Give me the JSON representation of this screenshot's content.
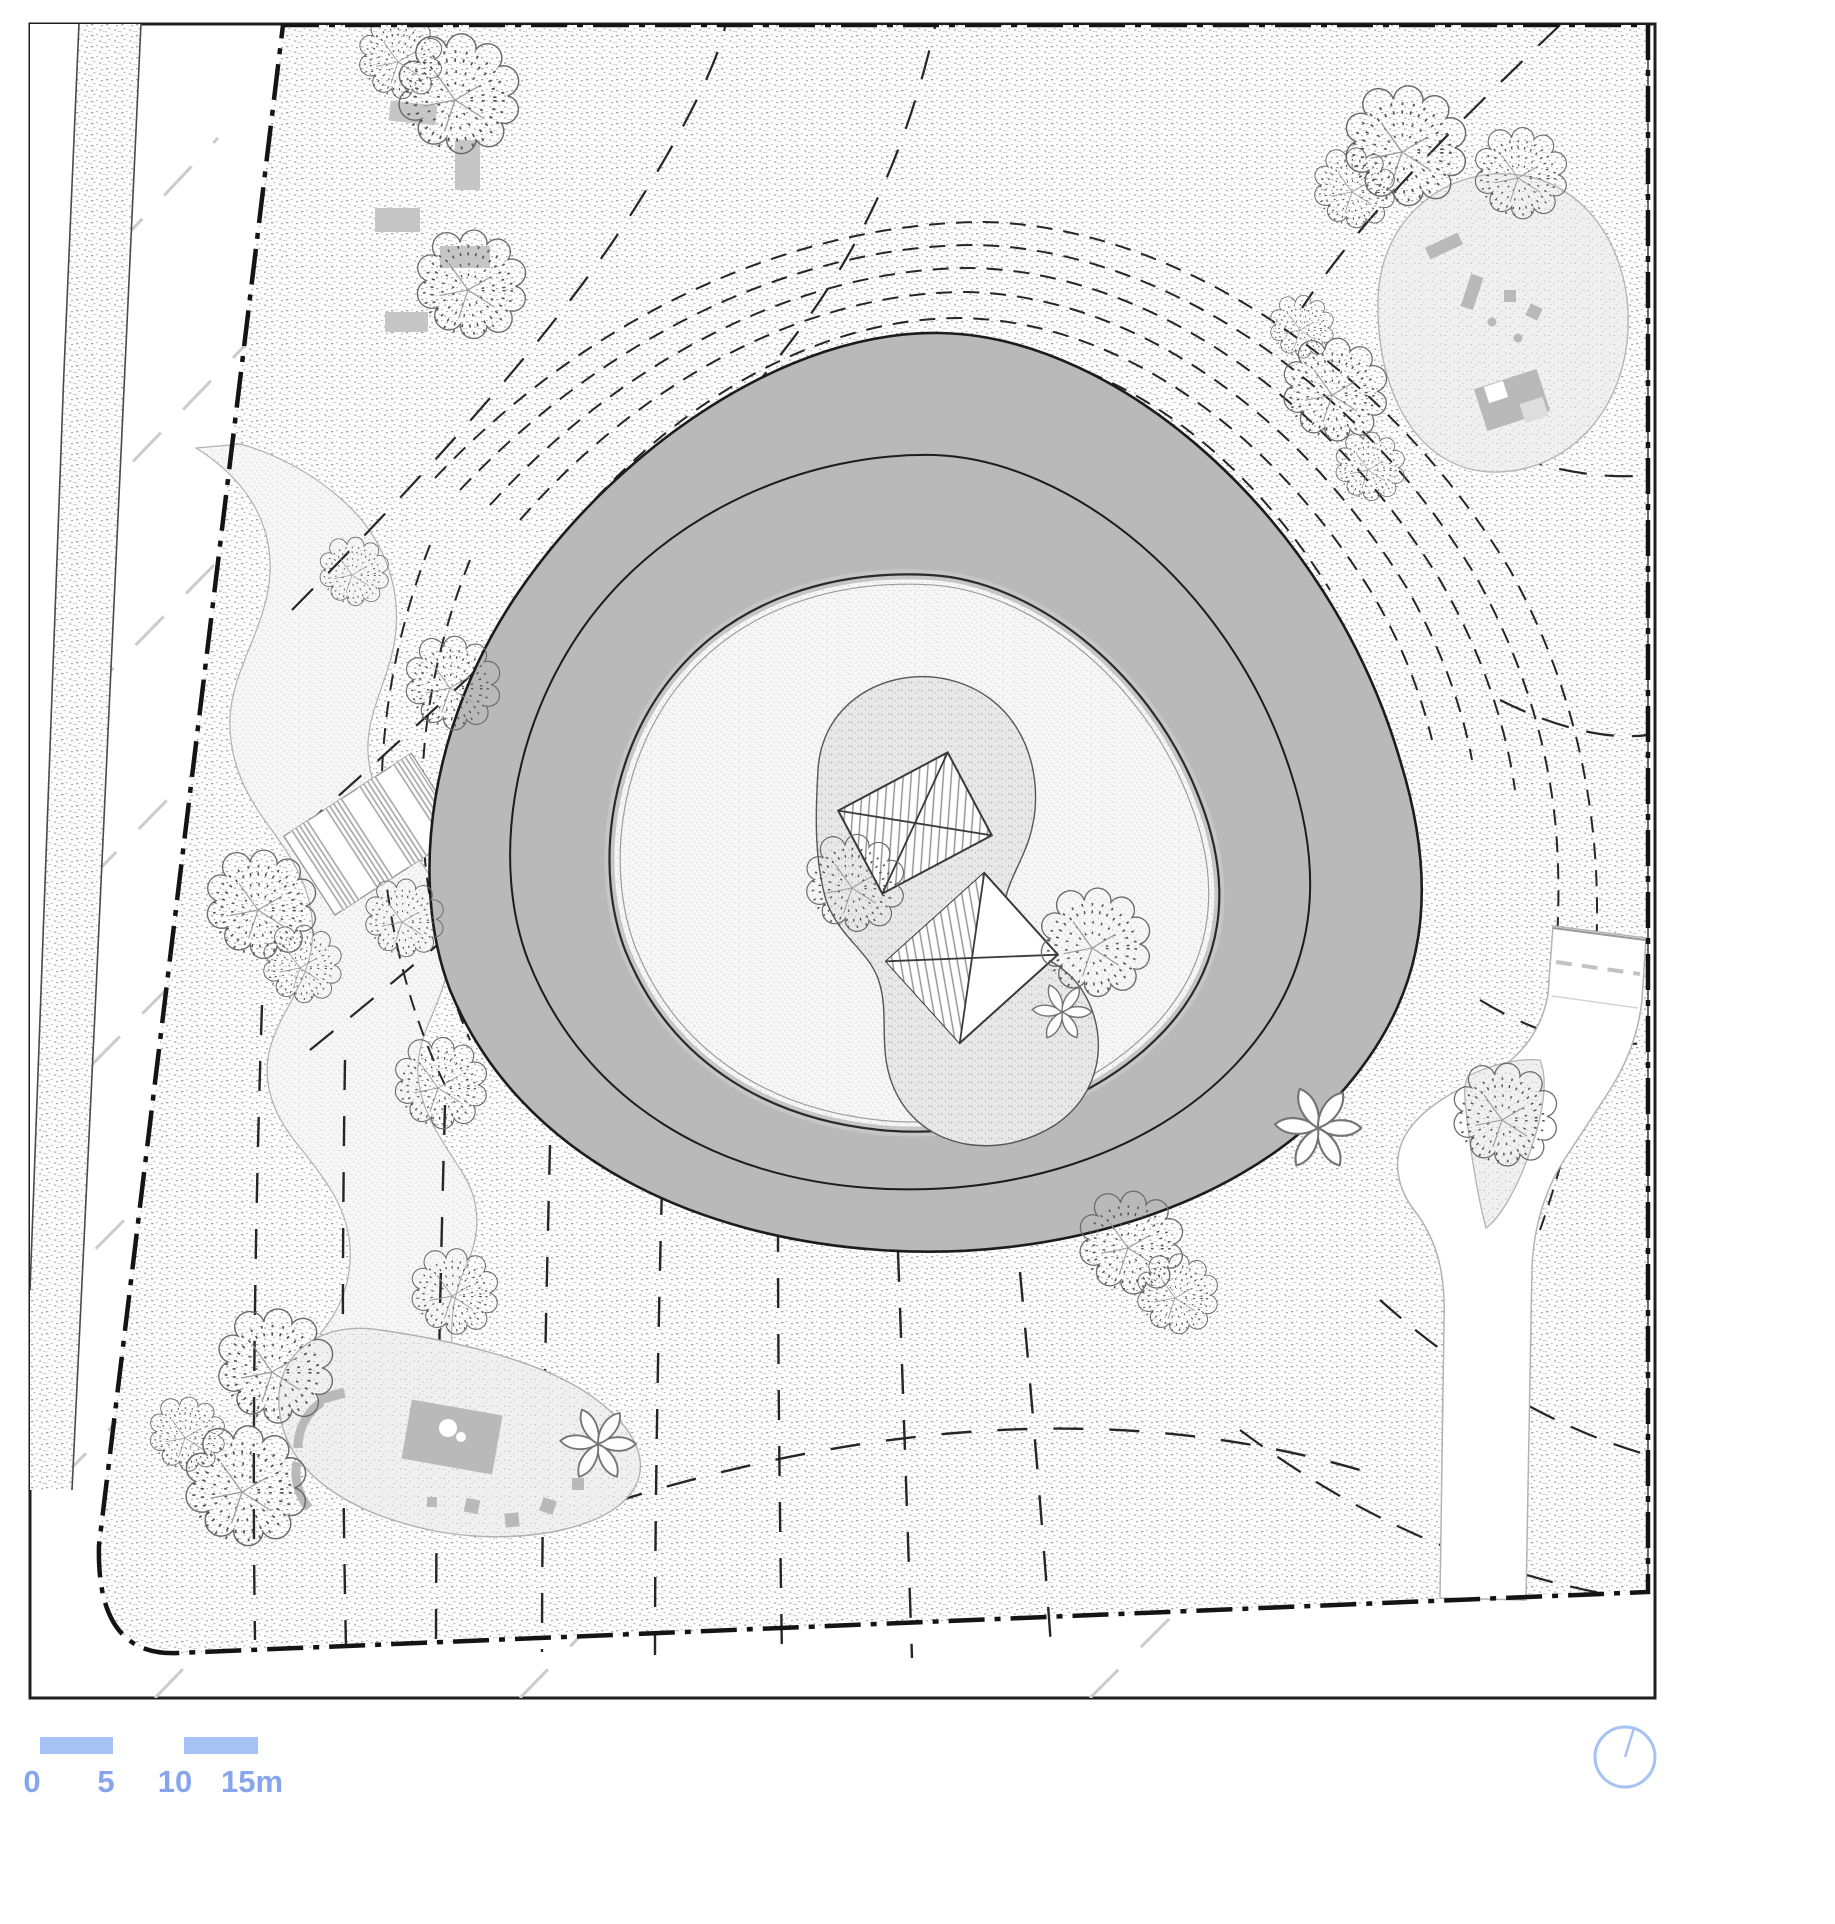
{
  "drawing": {
    "title": "landscape-site-plan",
    "description": "Site plan with central circular mound, inner plaza with two pavilions, paths, trees and play areas"
  },
  "scale_bar": {
    "labels": [
      "0",
      "5",
      "10",
      "15m"
    ],
    "bar_color": "#a6c1f4",
    "text_color": "#86a5ec"
  },
  "north_indicator": {
    "icon": "compass-circle",
    "color": "#a6c1f4"
  },
  "colors": {
    "mound_gray": "#b9b9b9",
    "platform_gray": "#e8e8e8",
    "equipment_gray": "#b9b9b9",
    "contour_line": "#262626",
    "boundary_line": "#141414",
    "margin_dash_gray": "#cbcbcb"
  }
}
